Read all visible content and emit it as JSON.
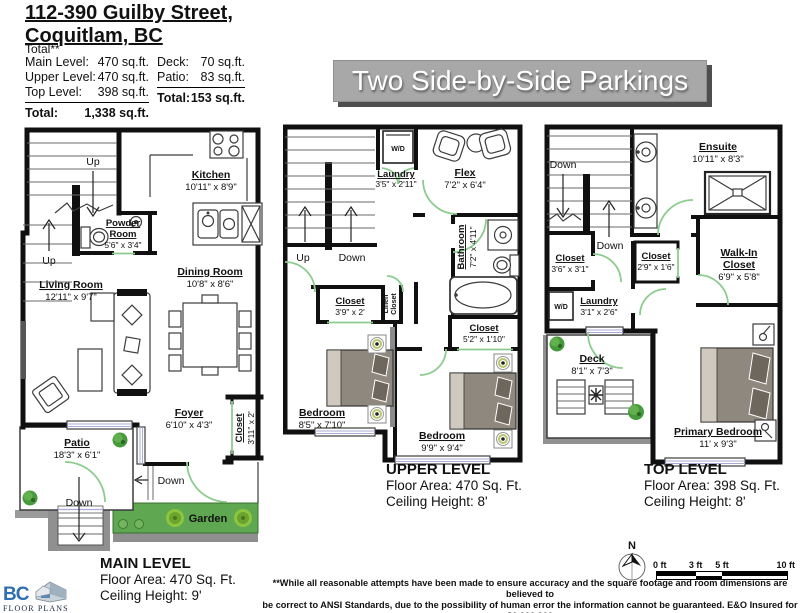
{
  "header": {
    "title1": "112-390 Guilby Street,",
    "title2": "Coquitlam, BC",
    "total_note": "Total**",
    "rows_left": [
      {
        "label": "Main Level:",
        "value": "470 sq.ft."
      },
      {
        "label": "Upper Level:",
        "value": "470 sq.ft."
      },
      {
        "label": "Top Level:",
        "value": "398 sq.ft."
      }
    ],
    "total_left": {
      "label": "Total:",
      "value": "1,338 sq.ft."
    },
    "rows_right": [
      {
        "label": "Deck:",
        "value": "70 sq.ft."
      },
      {
        "label": "Patio:",
        "value": "83 sq.ft."
      }
    ],
    "total_right": {
      "label": "Total:",
      "value": "153 sq.ft."
    }
  },
  "banner": {
    "text": "Two Side-by-Side Parkings"
  },
  "levels": {
    "main": {
      "title": "MAIN LEVEL",
      "floor_area": "Floor Area: 470 Sq. Ft.",
      "ceiling": "Ceiling Height: 9'",
      "rooms": {
        "kitchen": {
          "name": "Kitchen",
          "dims": "10'11\" x 8'9\""
        },
        "powder": {
          "name1": "Powder",
          "name2": "Room",
          "dims": "5'6\" x 3'4\""
        },
        "dining": {
          "name": "Dining Room",
          "dims": "10'8\" x 8'6\""
        },
        "living": {
          "name": "Living Room",
          "dims": "12'11\" x 9'7\""
        },
        "foyer": {
          "name": "Foyer",
          "dims": "6'10\" x 4'3\""
        },
        "closet": {
          "name": "Closet",
          "dims": "3'11\" x 2'"
        },
        "patio": {
          "name": "Patio",
          "dims": "18'3\" x 6'1\""
        },
        "garden": {
          "name": "Garden"
        }
      },
      "nav": {
        "up1": "Up",
        "up2": "Up",
        "down1": "Down",
        "down2": "Down"
      }
    },
    "upper": {
      "title": "UPPER LEVEL",
      "floor_area": "Floor Area: 470 Sq. Ft.",
      "ceiling": "Ceiling Height: 8'",
      "wd": "W/D",
      "rooms": {
        "laundry": {
          "name": "Laundry",
          "dims": "3'5\" x 2'11\""
        },
        "flex": {
          "name": "Flex",
          "dims": "7'2\" x 6'4\""
        },
        "bathroom": {
          "name": "Bathroom",
          "dims": "7'2\" x 4'11\""
        },
        "closet1": {
          "name": "Closet",
          "dims": "3'9\" x 2'"
        },
        "linen": {
          "name1": "Linen",
          "name2": "Closet"
        },
        "closet2": {
          "name": "Closet",
          "dims": "5'2\" x 1'10\""
        },
        "bedroom1": {
          "name": "Bedroom",
          "dims": "8'5\" x 7'10\""
        },
        "bedroom2": {
          "name": "Bedroom",
          "dims": "9'9\" x 9'4\""
        }
      },
      "nav": {
        "up": "Up",
        "down": "Down"
      }
    },
    "top": {
      "title": "TOP LEVEL",
      "floor_area": "Floor Area: 398 Sq. Ft.",
      "ceiling": "Ceiling Height: 8'",
      "wd": "W/D",
      "rooms": {
        "ensuite": {
          "name": "Ensuite",
          "dims": "10'11\" x 8'3\""
        },
        "closet1": {
          "name": "Closet",
          "dims": "3'6\" x 3'1\""
        },
        "closet2": {
          "name": "Closet",
          "dims": "2'9\" x 1'6\""
        },
        "walkin": {
          "name1": "Walk-In",
          "name2": "Closet",
          "dims": "6'9\" x 5'8\""
        },
        "laundry": {
          "name": "Laundry",
          "dims": "3'1\" x 2'6\""
        },
        "deck": {
          "name": "Deck",
          "dims": "8'1\" x 7'3\""
        },
        "primary": {
          "name": "Primary Bedroom",
          "dims": "11' x 9'3\""
        }
      },
      "nav": {
        "down1": "Down",
        "down2": "Down"
      }
    }
  },
  "footer": {
    "compass": "N",
    "scale": {
      "t0": "0 ft",
      "t3": "3 ft",
      "t5": "5 ft",
      "t10": "10 ft"
    },
    "disclaimer1": "**While all reasonable attempts have been made to ensure accuracy and the square footage and room dimensions are believed to",
    "disclaimer2": "be correct to ANSI Standards, due to the possibility of human error the information cannot be guaranteed. E&O Insured for $1,000,000",
    "disclaimer3": "** May Include Unfinished areas"
  },
  "logo": {
    "abbr": "BC",
    "name": "FLOOR PLANS"
  },
  "colors": {
    "banner_bg": "#a8a8a8",
    "banner_shadow": "#4e4e4e",
    "door_green": "#8ccc8e",
    "garden_green": "#5fa751",
    "outdoor_gray": "#909090",
    "logo_blue": "#2f6fb2"
  }
}
